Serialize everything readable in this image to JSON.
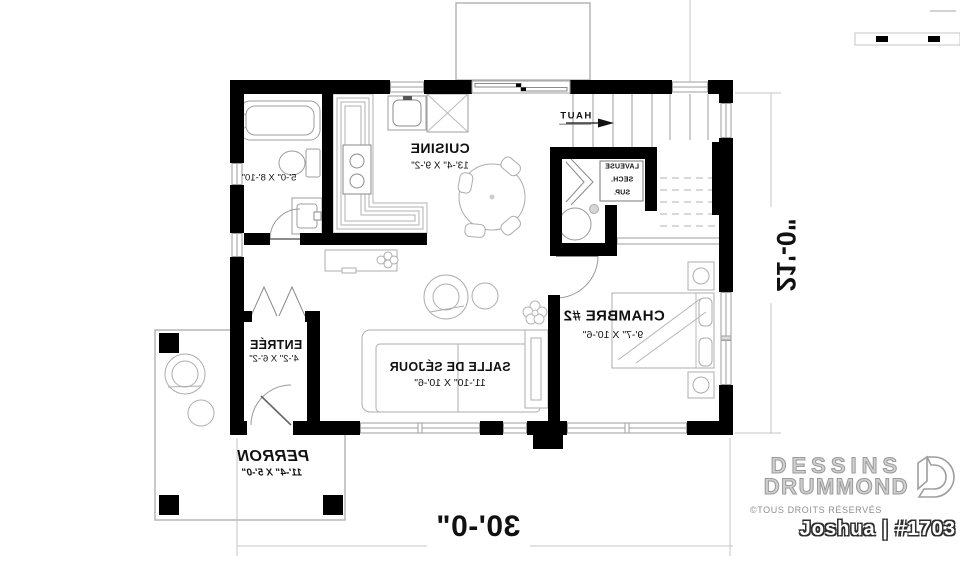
{
  "plan": {
    "rooms": {
      "cuisine": {
        "name": "CUISINE",
        "dims": "13'-4\" X 9'-2\""
      },
      "salle_de_bain": {
        "dims": "5'-0\" X 8'-10\""
      },
      "chambre2": {
        "name": "CHAMBRE #2",
        "dims": "9'-7\" X 10'-6\""
      },
      "sejour": {
        "name": "SALLE DE SÉJOUR",
        "dims": "11'-10\" X 10'-6\""
      },
      "entree": {
        "name": "ENTRÉE",
        "dims": "4'-2\" X 6'-2\""
      },
      "perron": {
        "name": "PERRON",
        "dims": "11'-4\" X 5'-0\""
      }
    },
    "stairs_label": "HAUT",
    "laundry": {
      "line1": "LAVEUSE",
      "line2": "SECH.",
      "line3": "SUP."
    },
    "overall_width": "30'-0\"",
    "overall_depth": "21'-0\""
  },
  "branding": {
    "name_line1": "DESSINS",
    "name_line2": "DRUMMOND",
    "copyright": "©TOUS DROITS RÉSERVÉS",
    "model": "Joshua | #1703"
  },
  "colors": {
    "wall": "#000000",
    "furniture_outline": "#aaaaaa",
    "dimension_line": "#c4c4c4",
    "label_text": "#111111",
    "brand_gray": "#9a9a9a"
  }
}
